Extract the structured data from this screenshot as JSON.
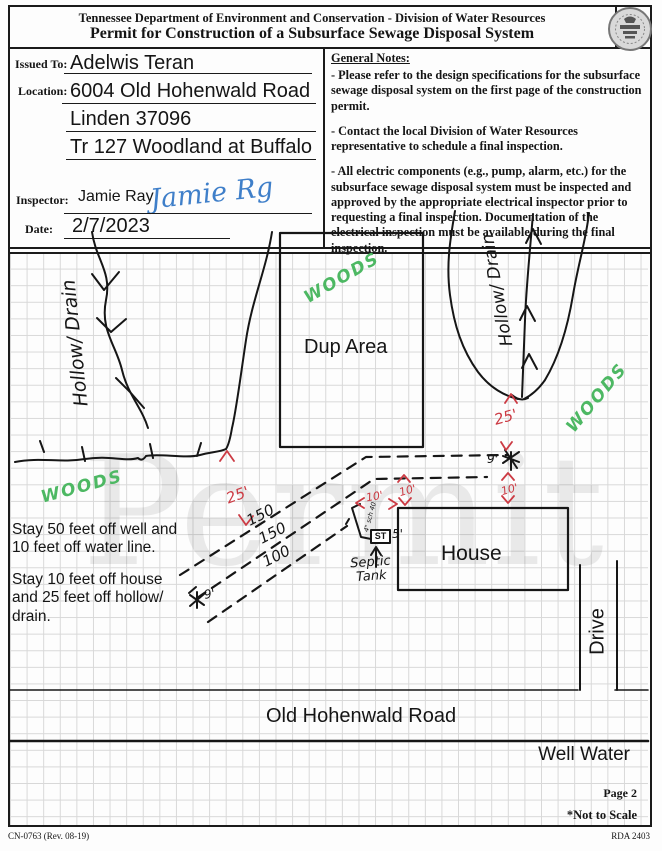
{
  "header": {
    "agency_line": "Tennessee Department of Environment and Conservation - Division of Water Resources",
    "title": "Permit for Construction of a Subsurface Sewage Disposal System"
  },
  "form": {
    "issued_to_label": "Issued To:",
    "issued_to": "Adelwis Teran",
    "location_label": "Location:",
    "location_line1": "6004 Old Hohenwald Road",
    "location_line2": "Linden 37096",
    "location_line3": "Tr 127 Woodland at Buffalo",
    "inspector_label": "Inspector:",
    "inspector": "Jamie Ray",
    "inspector_signature": "Jamie Rg",
    "date_label": "Date:",
    "date": "2/7/2023"
  },
  "general_notes": {
    "heading": "General Notes:",
    "notes": [
      "- Please refer to the design specifications for the subsurface sewage disposal system on the first page of the construction permit.",
      "- Contact the local Division of Water Resources representative to schedule a final inspection.",
      "- All electric components (e.g., pump, alarm, etc.) for the subsurface sewage disposal system must be inspected and approved by the appropriate electrical inspector prior to requesting a final inspection. Documentation of the electrical inspection must be available during the final inspection."
    ]
  },
  "site_map": {
    "watermark": "Permit",
    "labels": {
      "hollow_drain_left": "Hollow/ Drain",
      "hollow_drain_right": "Hollow/ Drain",
      "woods_left": "WOODS",
      "woods_top": "WOODS",
      "woods_right": "WOODS",
      "dup_area": "Dup Area",
      "house": "House",
      "drive": "Drive",
      "septic_tank": "Septic Tank",
      "st_box": "ST",
      "pipe_note": "4\" sch 40"
    },
    "dimensions": {
      "hollow_left_offset": "25'",
      "hollow_right_offset": "25'",
      "field_line1_length": "150",
      "field_line2_length": "150",
      "field_line3_length": "100",
      "line_spacing": "9'",
      "tank_side": "5'",
      "tank_to_house": "10'",
      "field_to_house": "10'",
      "tree_height": "9'",
      "tree_to_house": "10'"
    },
    "notes": [
      "Stay 50 feet off well and 10 feet off water line.",
      "Stay 10 feet off house and 25 feet off hollow/ drain."
    ],
    "road_label": "Old Hohenwald Road",
    "well_water_label": "Well Water"
  },
  "footer": {
    "page": "Page 2",
    "not_to_scale": "*Not to Scale",
    "form_number": "CN-0763 (Rev. 08-19)",
    "rda": "RDA 2403"
  },
  "colors": {
    "ink_red": "#cc3b44",
    "ink_green": "#4db863",
    "ink_blue": "#3f7fc9",
    "grid": "#d8d8d8",
    "watermark": "rgba(0,0,0,0.08)"
  }
}
